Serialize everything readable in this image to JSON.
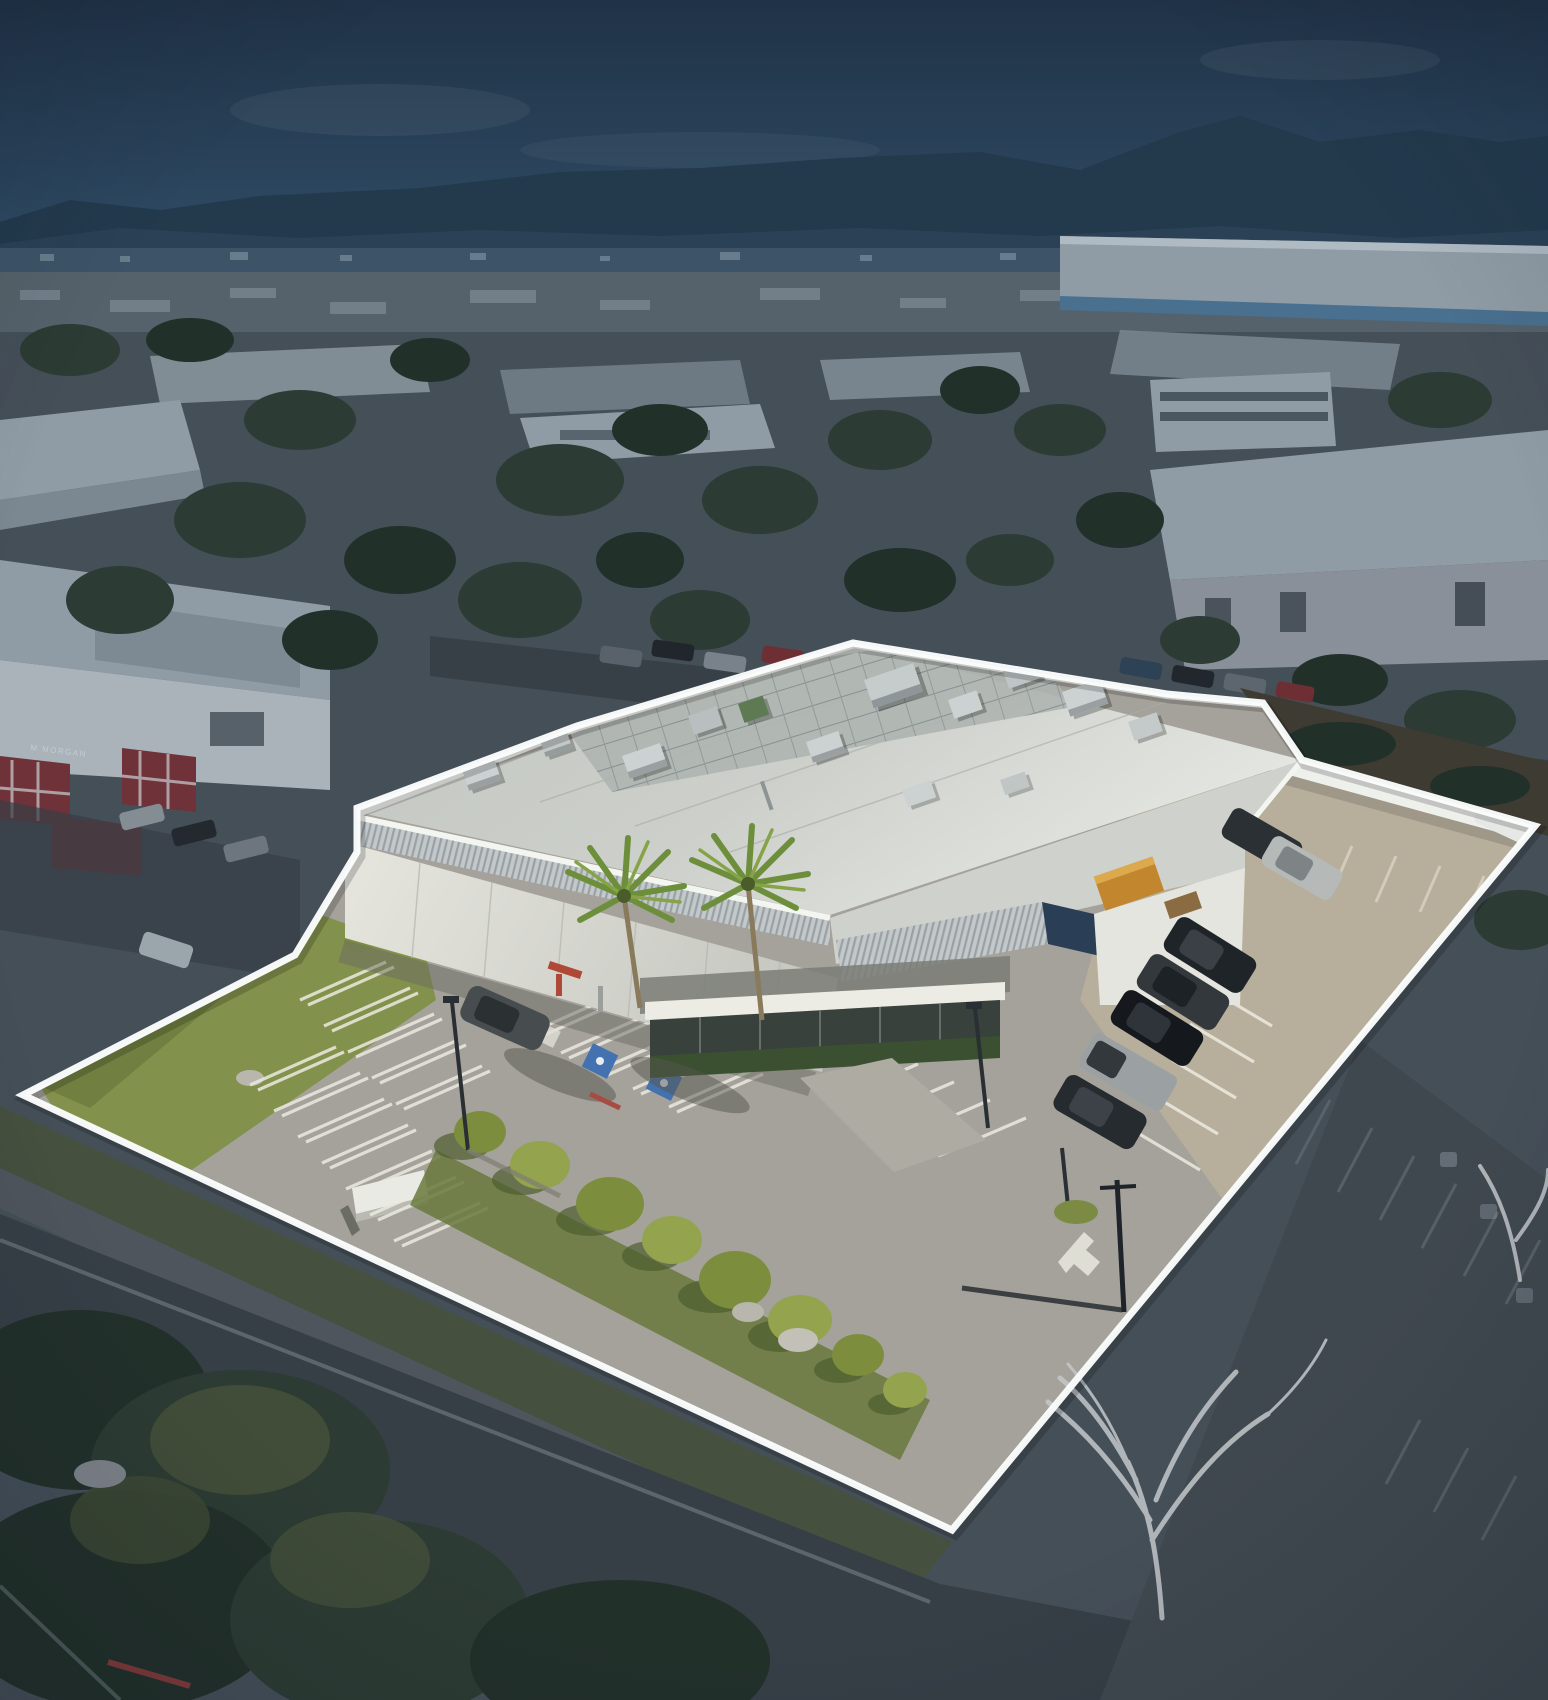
{
  "meta": {
    "title": "Aerial property photo with boundary outline",
    "width": 1548,
    "height": 1700
  },
  "scene": {
    "description": "Daytime aerial drone photo of a single-story white industrial/office building with rooftop HVAC equipment, front parking lot, lawns and palm trees, outlined by a white property boundary; all surrounding streets, buildings and hills are dimmed with a dark blue overlay; mountains on the horizon.",
    "subject": "outlined industrial building and parking lot",
    "surroundings_dimmed": true
  },
  "signage": {
    "neighbor_building_sign": "M MORGAN"
  },
  "overlay": {
    "boundary_points": "23,1095 295,955 357,852 357,808 577,726 853,643 1167,694 1263,703 1302,760 1535,826 952,1530",
    "boundary_stroke_width": 7
  },
  "colors": {
    "sky_top": "#223549",
    "sky_bottom": "#2f4d66",
    "mountain": "#233a4d",
    "mountain_near": "#2c4356",
    "haze": "#41586c",
    "dim_ground": "#454f58",
    "dim_road": "#363e46",
    "dim_tree": "#2c3b33",
    "dim_tree_dark": "#22302a",
    "dim_roof": "#909ca5",
    "dim_roof_side": "#7b8791",
    "red_accent": "#6e3238",
    "boundary": "#fbfdfd",
    "asphalt": "#a5a29b",
    "concrete_yard": "#b7ae9b",
    "grass": "#82914b",
    "grass_shade": "#69793c",
    "tree_bright": "#7c8e3e",
    "tree_light": "#94a34d",
    "tree_shadow": "#4f5e2d",
    "roof": "#c7cac4",
    "roof_light": "#e0e2de",
    "parapet": "#f3f5f1",
    "wall": "#dcddd6",
    "glass": "#39413c",
    "navy_roof": "#2a3f55",
    "dumpster_orange": "#c1862e",
    "handicap_blue": "#4472b0",
    "stripe_white": "#eceae0",
    "car_dark": "#23282c",
    "car_silver": "#a4a9ab"
  }
}
